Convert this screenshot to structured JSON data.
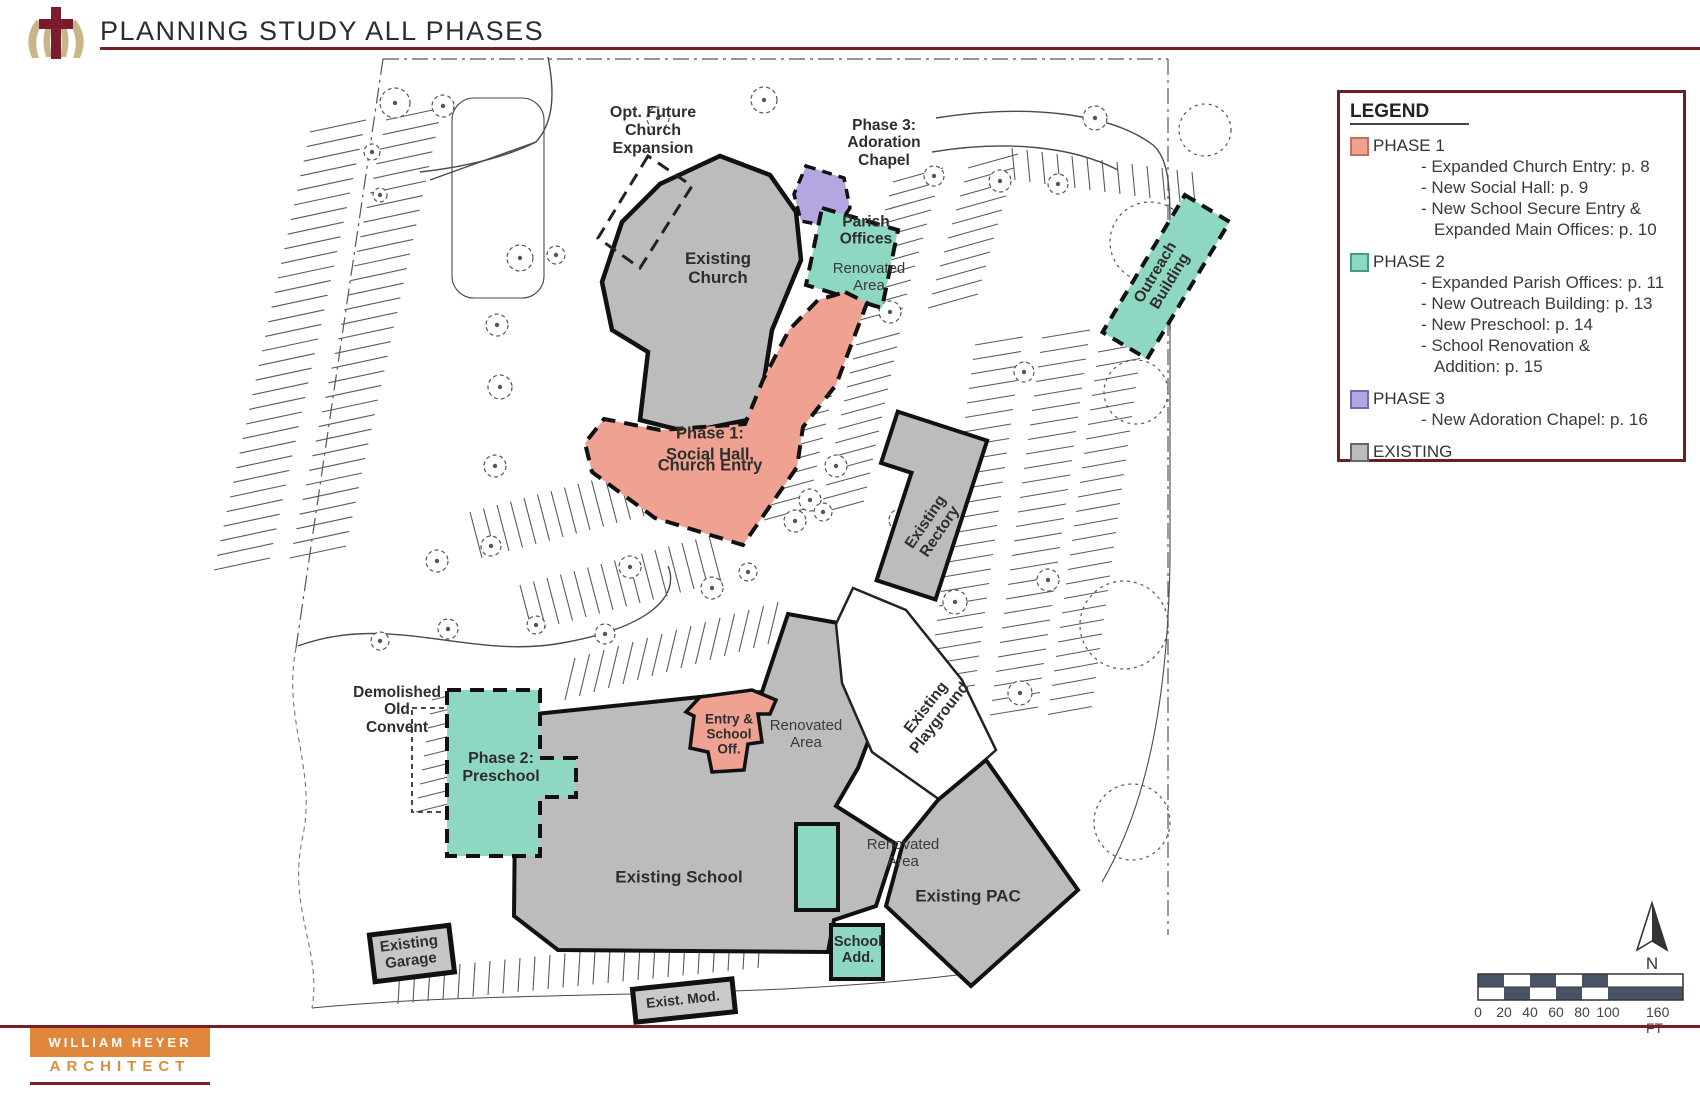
{
  "header": {
    "title": "PLANNING STUDY ALL PHASES"
  },
  "colors": {
    "phase1": "#efa292",
    "phase2": "#8ed7c2",
    "phase3": "#b4a6e0",
    "existing": "#bcbcbc",
    "accent_red": "#7a2022",
    "firm_orange": "#e0873c",
    "scale_dark": "#485465"
  },
  "legend": {
    "title": "LEGEND",
    "phase1": {
      "label": "PHASE 1",
      "item1": "- Expanded Church Entry: p. 8",
      "item2": "- New Social Hall: p. 9",
      "item3": "- New School Secure Entry &",
      "item4": "Expanded Main Offices: p. 10"
    },
    "phase2": {
      "label": "PHASE 2",
      "item1": "- Expanded Parish Offices: p. 11",
      "item2": "- New Outreach Building: p. 13",
      "item3": "- New Preschool: p. 14",
      "item4": "- School Renovation &",
      "item5": "Addition: p. 15"
    },
    "phase3": {
      "label": "PHASE 3",
      "item1": "- New Adoration Chapel: p. 16"
    },
    "existing": {
      "label": "EXISTING"
    }
  },
  "plan": {
    "opt_future": "Opt. Future\nChurch\nExpansion",
    "existing_church": "Existing\nChurch",
    "phase3_chapel": "Phase 3:\nAdoration\nChapel",
    "parish_offices": "Parish\nOffices",
    "renovated_parish": "Renovated\nArea",
    "phase1_social": "Phase 1:\n\nSocial Hall,\nChurch Entry",
    "outreach": "Outreach\nBuilding",
    "existing_rectory": "Existing\nRectory",
    "demolished": "Demolished\nOld\nConvent",
    "phase2_preschool": "Phase 2:\nPreschool",
    "entry_school": "Entry &\nSchool\nOff.",
    "renovated_entry": "Renovated\nArea",
    "existing_school": "Existing School",
    "existing_playground": "Existing\nPlayground",
    "existing_pac": "Existing PAC",
    "renovated_pac": "Renovated\nArea",
    "school_add": "School\nAdd.",
    "existing_garage": "Existing\nGarage",
    "exist_mod": "Exist. Mod."
  },
  "compass": {
    "north": "N"
  },
  "scalebar": {
    "t0": "0",
    "t1": "20",
    "t2": "40",
    "t3": "60",
    "t4": "80",
    "t5": "100",
    "t6": "160 FT"
  },
  "firm": {
    "line1": "WILLIAM HEYER",
    "line2": "ARCHITECT"
  }
}
